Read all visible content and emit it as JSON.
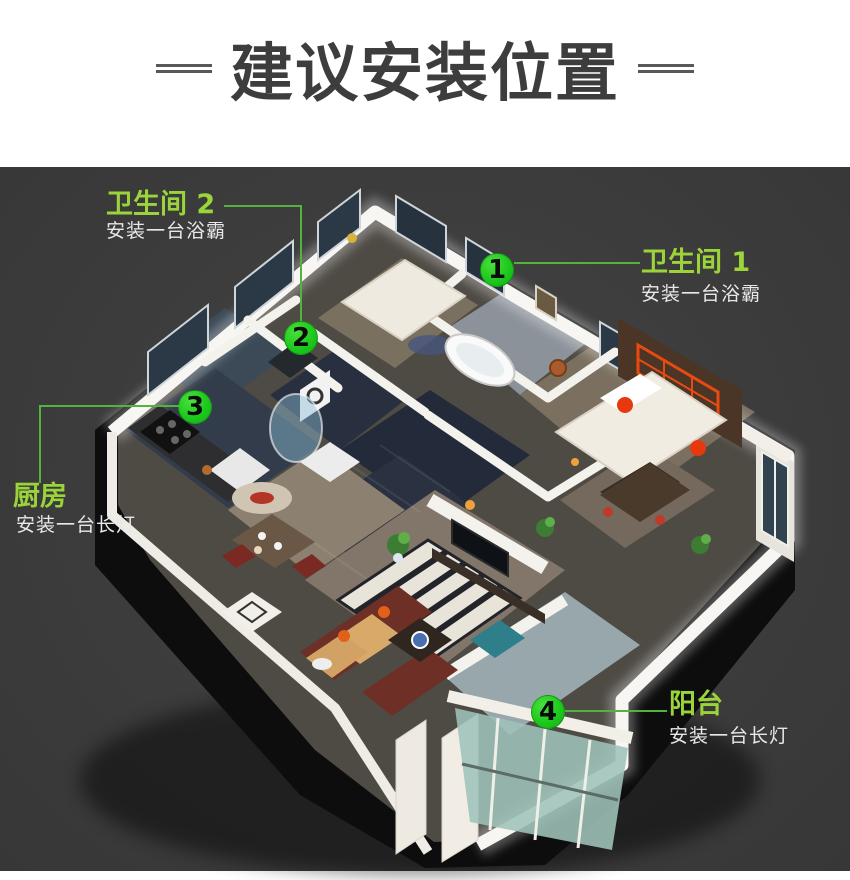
{
  "header": {
    "title": "建议安装位置"
  },
  "annotations": [
    {
      "number": "1",
      "room": "卫生间 1",
      "note": "安装一台浴霸"
    },
    {
      "number": "2",
      "room": "卫生间 2",
      "note": "安装一台浴霸"
    },
    {
      "number": "3",
      "room": "厨房",
      "note": "安装一台长灯"
    },
    {
      "number": "4",
      "room": "阳台",
      "note": "安装一台长灯"
    }
  ],
  "colors": {
    "label_green": "#9bd43a",
    "marker_green": "#1ec91e",
    "leader_green": "#55b23c",
    "panel_background": "#3b3b3b",
    "title_color": "#3d3d3d"
  }
}
